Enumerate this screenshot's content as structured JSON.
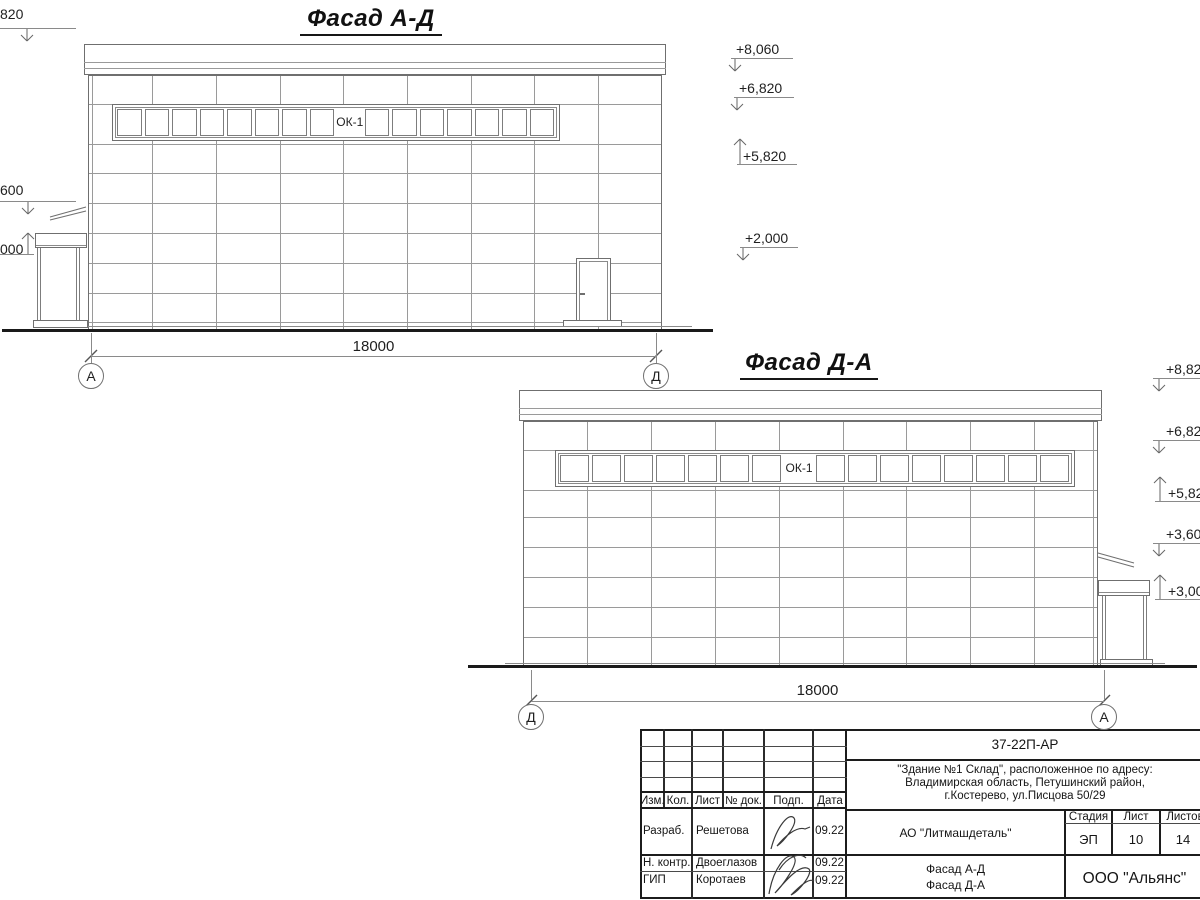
{
  "colors": {
    "joint": "#9a9a9a",
    "frame": "#6f6f6f",
    "ground": "#1a1a1a",
    "titleblock_line": "#2b2b2b",
    "text": "#1f1f1f"
  },
  "facade_ad": {
    "title": "Фасад А-Д",
    "window_label": "ОК-1",
    "dimension": "18000",
    "axis_left": "А",
    "axis_right": "Д",
    "elevations_left": [
      {
        "text": "820",
        "dir": "down"
      },
      {
        "text": "600",
        "dir": "down"
      },
      {
        "text": "000",
        "dir": "up"
      }
    ],
    "elevations_right": [
      {
        "text": "+8,060",
        "dir": "down"
      },
      {
        "text": "+6,820",
        "dir": "down"
      },
      {
        "text": "+5,820",
        "dir": "up"
      },
      {
        "text": "+2,000",
        "dir": "down"
      }
    ]
  },
  "facade_da": {
    "title": "Фасад Д-А",
    "window_label": "ОК-1",
    "dimension": "18000",
    "axis_left": "Д",
    "axis_right": "А",
    "elevations_right": [
      {
        "text": "+8,820",
        "dir": "down"
      },
      {
        "text": "+6,820",
        "dir": "down"
      },
      {
        "text": "+5,820",
        "dir": "up"
      },
      {
        "text": "+3,600",
        "dir": "down"
      },
      {
        "text": "+3,000",
        "dir": "up"
      }
    ]
  },
  "title_block": {
    "doc_number": "37-22П-АР",
    "address_lines": [
      "\"Здание №1 Склад\", расположенное по адресу:",
      "Владимирская область, Петушинский район,",
      "г.Костерево, ул.Писцова 50/29"
    ],
    "header_cols": [
      "Изм.",
      "Кол.",
      "Лист",
      "№ док.",
      "Подп.",
      "Дата"
    ],
    "rows": [
      {
        "role": "Разраб.",
        "name": "Решетова",
        "date": "09.22"
      },
      {
        "role": "Н. контр.",
        "name": "Двоеглазов",
        "date": "09.22"
      },
      {
        "role": "ГИП",
        "name": "Коротаев",
        "date": "09.22"
      }
    ],
    "company": "АО \"Литмашдеталь\"",
    "stage_label": "Стадия",
    "sheet_label": "Лист",
    "sheets_label": "Листов",
    "stage": "ЭП",
    "sheet": "10",
    "sheets": "14",
    "drawing_name_lines": [
      "Фасад А-Д",
      "Фасад Д-А"
    ],
    "org": "ООО \"Альянс\""
  }
}
